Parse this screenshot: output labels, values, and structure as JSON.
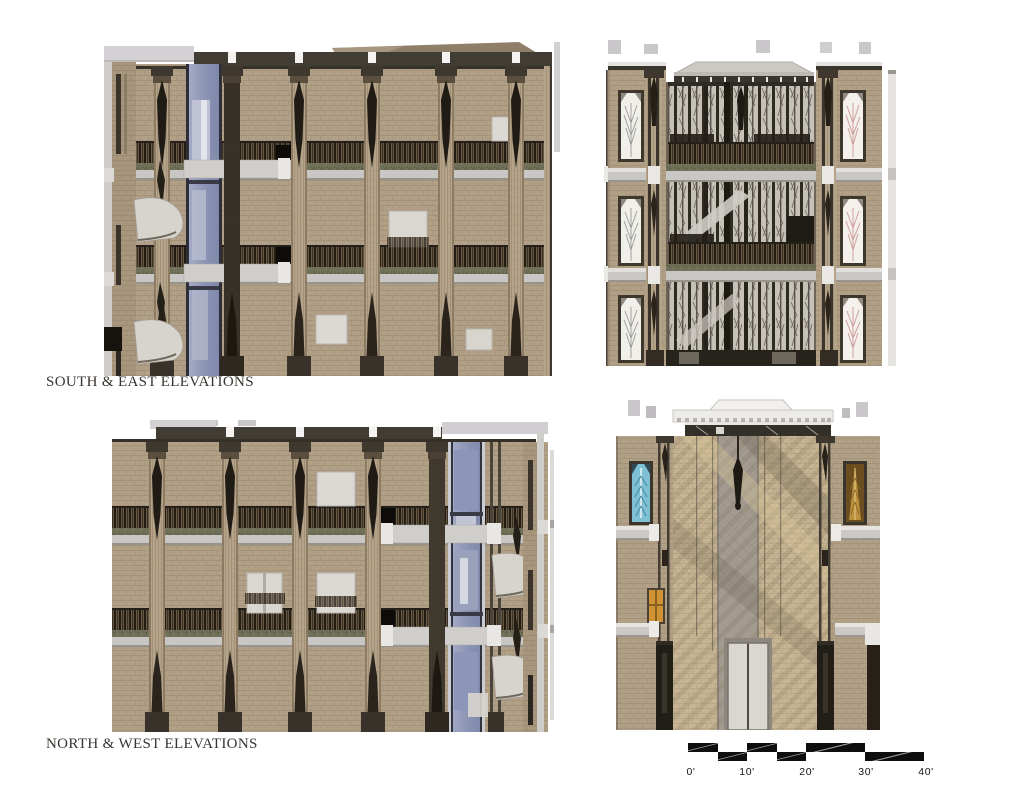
{
  "captions": {
    "top": "SOUTH & EAST ELEVATIONS",
    "bottom": "NORTH & WEST ELEVATIONS"
  },
  "panels": [
    {
      "id": "south-elevation",
      "group": "SOUTH & EAST ELEVATIONS",
      "position": "top-left"
    },
    {
      "id": "east-elevation",
      "group": "SOUTH & EAST ELEVATIONS",
      "position": "top-right"
    },
    {
      "id": "north-elevation",
      "group": "NORTH & WEST ELEVATIONS",
      "position": "bottom-left"
    },
    {
      "id": "west-elevation",
      "group": "NORTH & WEST ELEVATIONS",
      "position": "bottom-right"
    }
  ],
  "scale_bar": {
    "labels": [
      "0'",
      "10'",
      "20'",
      "30'",
      "40'"
    ],
    "feet_per_major_division": 10,
    "bar_color": "#0e0e0e"
  },
  "palette": {
    "background": "#ffffff",
    "brick_tan": "#b1a085",
    "brick_mortar": "#a08f76",
    "brick_sunlit": "#c6b492",
    "pier_dark_ornament": "#201b15",
    "cornice_gray": "#d3d1d4",
    "roof_band_dark": "#413c34",
    "ledge_gray": "#c9c7c3",
    "railing_dark": "#231c13",
    "planter_green": "#6f7057",
    "curtainwall_blue": "#8b93b4",
    "window_light": "#dcd9d4",
    "stained_glass_blue": "#7fc0d4",
    "stained_glass_amber": "#b9913f",
    "stained_glass_pink": "#cf9f9f",
    "caption_text": "#38342f"
  }
}
